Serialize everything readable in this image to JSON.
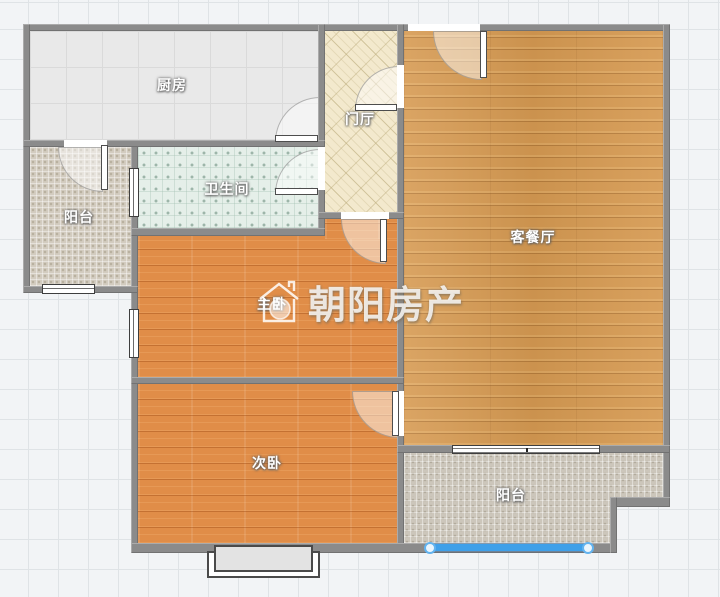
{
  "app": {
    "type": "floor-plan-viewer"
  },
  "watermark": {
    "text": "朝阳房产",
    "icon": "house-logo-icon"
  },
  "rooms": [
    {
      "id": "kitchen",
      "label": "厨房",
      "floor": "gray-tile"
    },
    {
      "id": "entry-hall",
      "label": "门厅",
      "floor": "beige-lattice-tile"
    },
    {
      "id": "living-dining",
      "label": "客餐厅",
      "floor": "golden-wood-plank"
    },
    {
      "id": "bathroom",
      "label": "卫生间",
      "floor": "teal-dot-tile"
    },
    {
      "id": "balcony-left",
      "label": "阳台",
      "floor": "beige-mosaic-tile"
    },
    {
      "id": "master-bedroom",
      "label": "主卧",
      "floor": "orange-wood-plank"
    },
    {
      "id": "second-bedroom",
      "label": "次卧",
      "floor": "orange-wood-plank"
    },
    {
      "id": "balcony-bottom",
      "label": "阳台",
      "floor": "gray-mosaic-tile"
    }
  ],
  "selection": {
    "target": "balcony-bottom-window",
    "color": "#3fa0e9",
    "handle_color": "#62b3ef"
  },
  "colors": {
    "wall": "#8b8b8b",
    "grid_line": "#dfe3e6",
    "background": "#f2f4f6"
  }
}
